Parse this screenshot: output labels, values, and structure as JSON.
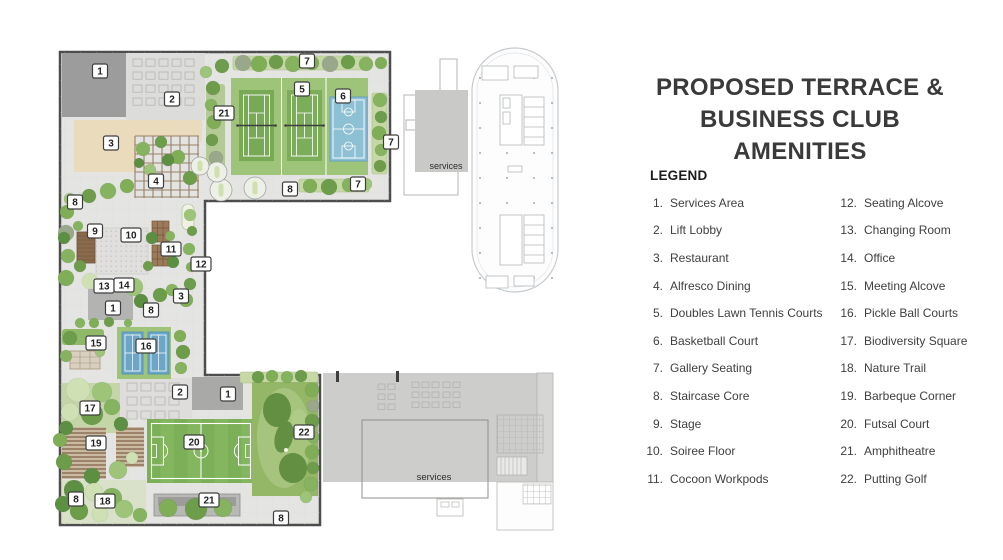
{
  "header": {
    "title": "PROPOSED TERRACE & BUSINESS CLUB AMENITIES"
  },
  "legend": {
    "title": "LEGEND",
    "columns": [
      [
        {
          "num": "1.",
          "label": "Services Area"
        },
        {
          "num": "2.",
          "label": "Lift Lobby"
        },
        {
          "num": "3.",
          "label": "Restaurant"
        },
        {
          "num": "4.",
          "label": "Alfresco Dining"
        },
        {
          "num": "5.",
          "label": "Doubles Lawn Tennis Courts"
        },
        {
          "num": "6.",
          "label": "Basketball Court"
        },
        {
          "num": "7.",
          "label": "Gallery Seating"
        },
        {
          "num": "8.",
          "label": "Staircase Core"
        },
        {
          "num": "9.",
          "label": "Stage"
        },
        {
          "num": "10.",
          "label": "Soiree Floor"
        },
        {
          "num": "11.",
          "label": "Cocoon Workpods"
        }
      ],
      [
        {
          "num": "12.",
          "label": "Seating Alcove"
        },
        {
          "num": "13.",
          "label": "Changing Room"
        },
        {
          "num": "14.",
          "label": "Office"
        },
        {
          "num": "15.",
          "label": "Meeting Alcove"
        },
        {
          "num": "16.",
          "label": "Pickle Ball Courts"
        },
        {
          "num": "17.",
          "label": "Biodiversity Square"
        },
        {
          "num": "18.",
          "label": "Nature Trail"
        },
        {
          "num": "19.",
          "label": "Barbeque Corner"
        },
        {
          "num": "20.",
          "label": "Futsal Court"
        },
        {
          "num": "21.",
          "label": "Amphitheatre"
        },
        {
          "num": "22.",
          "label": "Putting Golf"
        }
      ]
    ]
  },
  "plan": {
    "services_label_top": "services",
    "services_label_bottom": "services",
    "badges": [
      {
        "n": "1",
        "x": 100,
        "y": 71
      },
      {
        "n": "2",
        "x": 172,
        "y": 99
      },
      {
        "n": "3",
        "x": 111,
        "y": 143
      },
      {
        "n": "21",
        "x": 224,
        "y": 113
      },
      {
        "n": "7",
        "x": 307,
        "y": 61
      },
      {
        "n": "5",
        "x": 302,
        "y": 89
      },
      {
        "n": "6",
        "x": 343,
        "y": 96
      },
      {
        "n": "7",
        "x": 391,
        "y": 142
      },
      {
        "n": "7",
        "x": 358,
        "y": 184
      },
      {
        "n": "8",
        "x": 290,
        "y": 189
      },
      {
        "n": "4",
        "x": 156,
        "y": 181
      },
      {
        "n": "8",
        "x": 75,
        "y": 202
      },
      {
        "n": "9",
        "x": 95,
        "y": 231
      },
      {
        "n": "10",
        "x": 131,
        "y": 235
      },
      {
        "n": "11",
        "x": 171,
        "y": 249
      },
      {
        "n": "12",
        "x": 201,
        "y": 264
      },
      {
        "n": "13",
        "x": 104,
        "y": 286
      },
      {
        "n": "14",
        "x": 124,
        "y": 285
      },
      {
        "n": "3",
        "x": 181,
        "y": 296
      },
      {
        "n": "1",
        "x": 113,
        "y": 308
      },
      {
        "n": "8",
        "x": 151,
        "y": 310
      },
      {
        "n": "15",
        "x": 96,
        "y": 343
      },
      {
        "n": "16",
        "x": 146,
        "y": 346
      },
      {
        "n": "2",
        "x": 180,
        "y": 392
      },
      {
        "n": "1",
        "x": 228,
        "y": 394
      },
      {
        "n": "17",
        "x": 90,
        "y": 408
      },
      {
        "n": "19",
        "x": 96,
        "y": 443
      },
      {
        "n": "20",
        "x": 194,
        "y": 442
      },
      {
        "n": "22",
        "x": 304,
        "y": 432
      },
      {
        "n": "8",
        "x": 76,
        "y": 499
      },
      {
        "n": "18",
        "x": 105,
        "y": 501
      },
      {
        "n": "21",
        "x": 209,
        "y": 500
      },
      {
        "n": "8",
        "x": 281,
        "y": 518
      }
    ],
    "colors": {
      "tennis_green": "#78aa55",
      "courts_surround_green": "#9dc479",
      "basketball_blue": "#8ec0d4",
      "pickleball_blue": "#6ba6c6",
      "futsal_green": "#7cb058",
      "putting_green": "#93b766",
      "restaurant_tan": "#ebdbbd",
      "services_gray": "#9c9c9c",
      "paving_gray": "#e4e4e2"
    }
  }
}
